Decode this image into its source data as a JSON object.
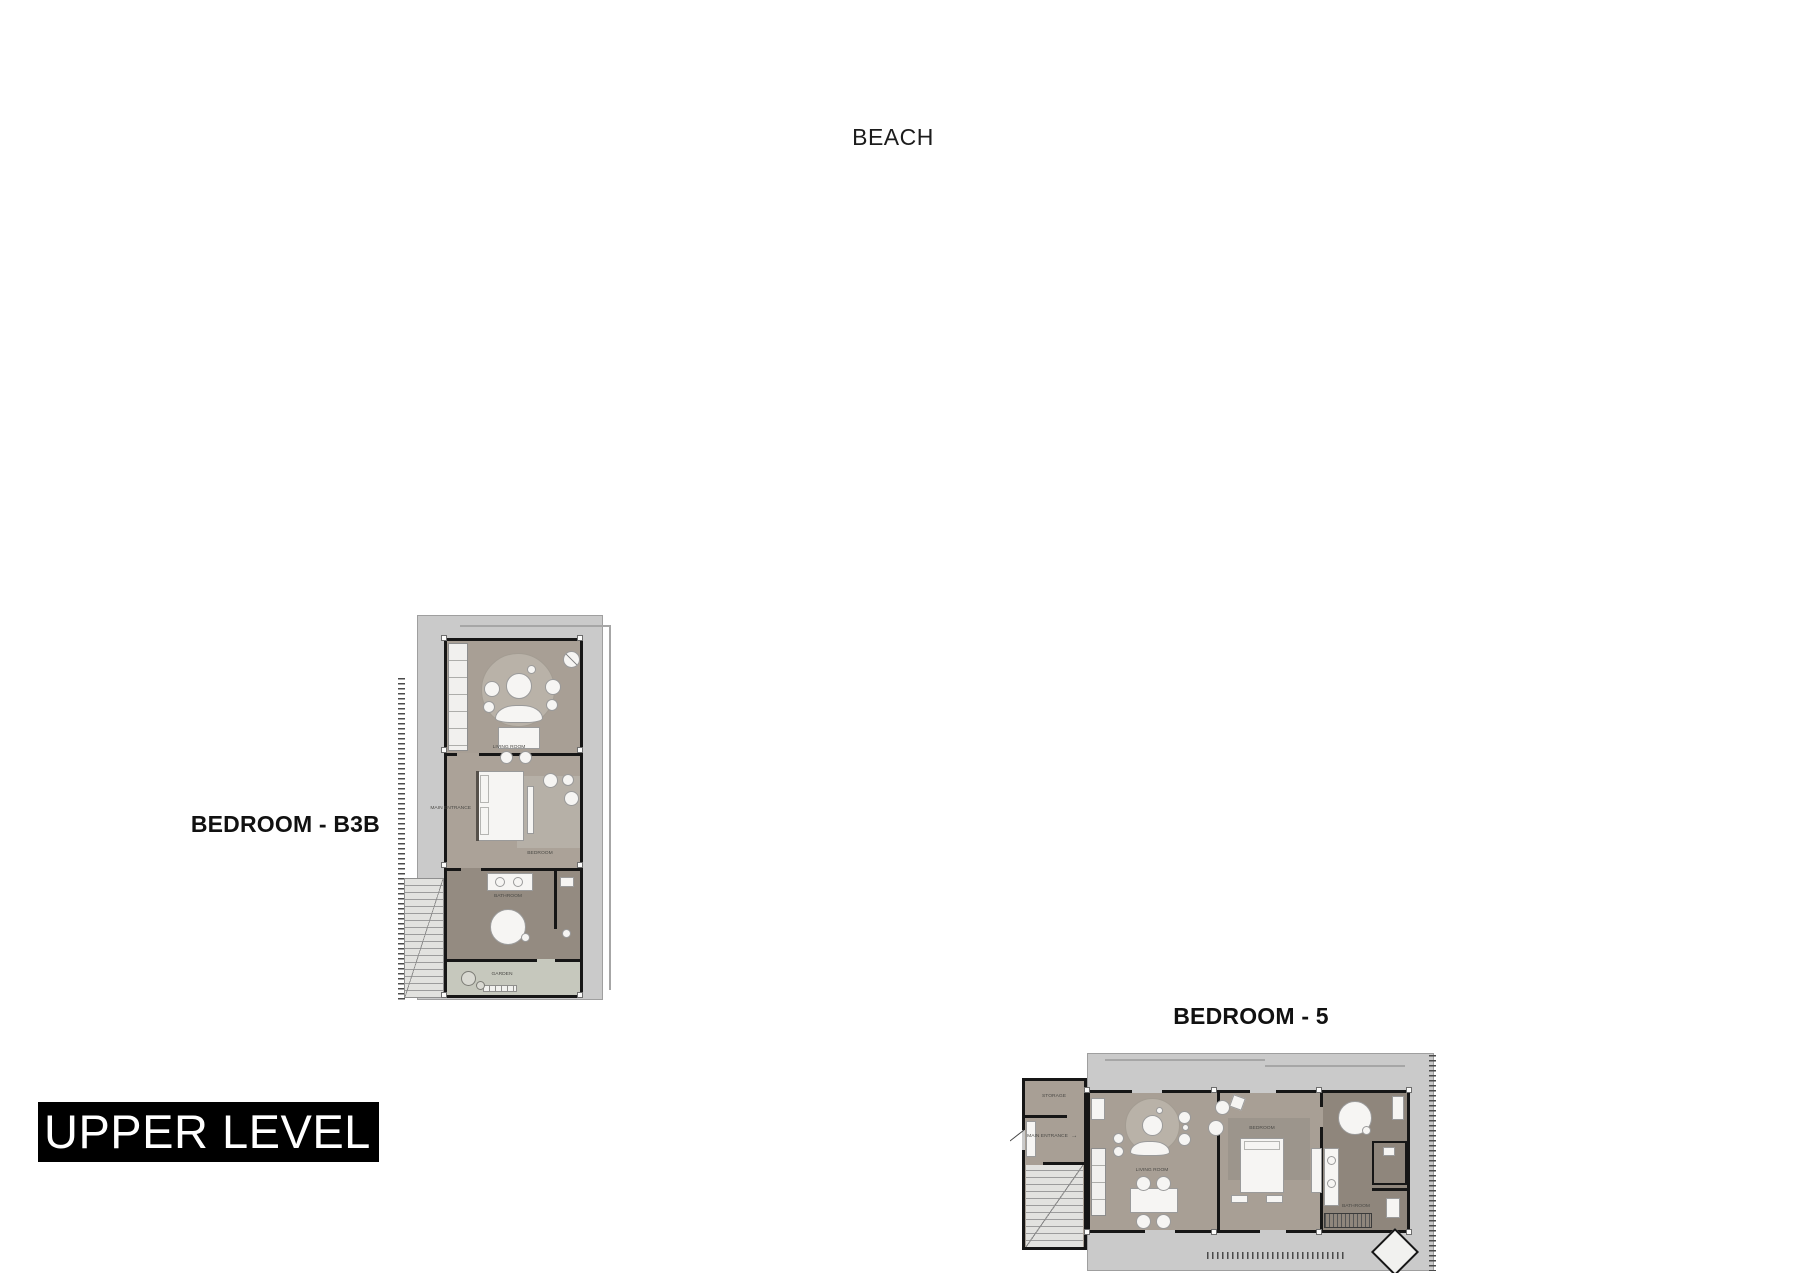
{
  "page": {
    "beach_label": "BEACH",
    "level_title": "UPPER LEVEL"
  },
  "plans": {
    "b3b": {
      "name": "BEDROOM - B3B",
      "rooms": {
        "living": "LIVING ROOM",
        "bedroom": "BEDROOM",
        "bathroom": "BATHROOM",
        "garden": "GARDEN",
        "main_entrance": "MAIN ENTRANCE"
      }
    },
    "b5": {
      "name": "BEDROOM - 5",
      "rooms": {
        "storage": "STORAGE",
        "main_entrance": "MAIN ENTRANCE",
        "entrance_arrow": "→",
        "living": "LIVING ROOM",
        "bedroom": "BEDROOM",
        "bathroom": "BATHROOM"
      }
    }
  },
  "colors": {
    "wall": "#161616",
    "deck": "#cacaca",
    "room": "#a89f95",
    "room_dark": "#8f867c",
    "rug": "#b9b2a8",
    "garden": "#c6c8bd",
    "furniture": "#f6f5f3",
    "title_bg": "#000000",
    "title_text": "#ffffff"
  }
}
